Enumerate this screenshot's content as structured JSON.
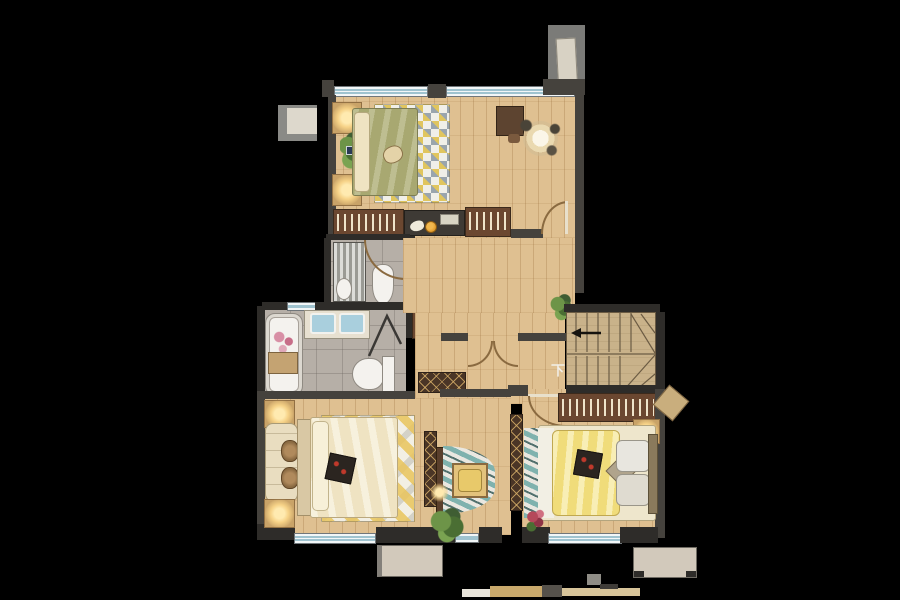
{
  "canvas": {
    "width": 900,
    "height": 600,
    "background": "#000000"
  },
  "labels": {
    "stairs_direction": "下"
  },
  "colors": {
    "wood": "#dfc091",
    "wall": "#45423d",
    "wall-dark": "#2e2c29",
    "marble": "#b6afa7",
    "window-fill": "#f2f6f7",
    "window-line": "#9fc3cf",
    "cabinet": "#6b4730",
    "nightstand": "#c9a368",
    "glow": "#f6d287",
    "olive": "#a8a871",
    "cream": "#efe3c2",
    "yellow": "#f0dc7a",
    "teal": "#7fb2ae",
    "green": "#6d9448",
    "stairs-wood": "#c9b28a",
    "lattice-bg": "#4a3526",
    "door": "#8a6a40",
    "gray-block": "#7b7b78",
    "beige": "#d2c9bb",
    "red": "#b5485a",
    "orange": "#e09a2a",
    "white-fixture": "#f4f2ee"
  }
}
